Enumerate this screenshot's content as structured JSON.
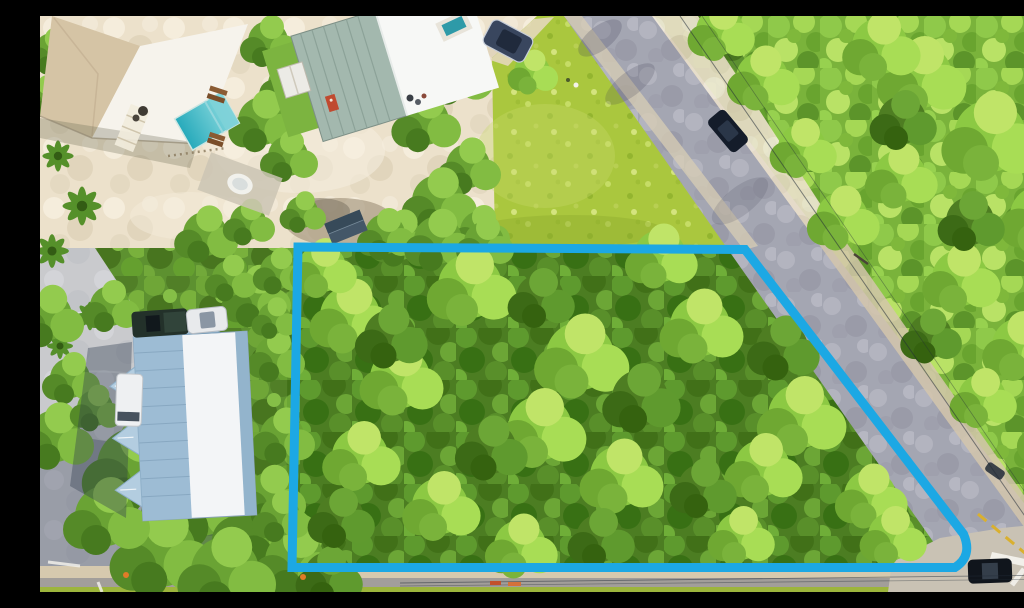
{
  "meta": {
    "kind": "aerial-drone-photograph",
    "subject": "vacant wooded corner lot outlined with a blue property boundary, neighboring homes with pool at top-left, diagonal access road on the right, street along the bottom",
    "canvas": {
      "width": 1024,
      "height": 576
    }
  },
  "annotation": {
    "boundary": {
      "label": "property-boundary-outline",
      "color": "#1CA8E4",
      "stroke_width": 9,
      "path": "M 258,231 L 705,233.5 L 923.5,518 Q 933,540 915,551.5 L 252,551.5 Z",
      "corners": [
        [
          258,
          231
        ],
        [
          705,
          233
        ],
        [
          924,
          518
        ],
        [
          915,
          552
        ],
        [
          252,
          552
        ]
      ]
    }
  },
  "palette": {
    "forest_base": "#5d9130",
    "forest_bright": "#7ab33b",
    "forest_dark": "#4c7d22",
    "field": "#aac73e",
    "sand": "#ece1cb",
    "road": "#a4a6b2",
    "road_shoulder": "#d3c6ab",
    "concrete": "#c9cacd",
    "intersection": "#c9c2b4",
    "sidewalk": "#d6c9ae",
    "bottom_road": "#a29e9a",
    "bottom_grass": "#9db53c",
    "pool_deep": "#27aabb",
    "pool_shallow": "#8fdce0",
    "roof_house_a_tan": "#d5c4a5",
    "roof_house_a_white": "#f6f3ec",
    "roof_house_b_metal": "#a3b8ae",
    "roof_house_b_white": "#f7f8f6",
    "roof_long_building": "#9dbcd4",
    "roof_long_building_white": "#f3f5f7",
    "shed_roof_dark": "#445768",
    "lawn": "#7cb440",
    "yellow_line": "#d9b02f",
    "marking_white": "#f2f0ea"
  },
  "features": [
    {
      "name": "property-boundary",
      "type": "annotation-overlay"
    },
    {
      "name": "wooded-lot",
      "type": "dense-tree-canopy"
    },
    {
      "name": "diagonal-access-road",
      "type": "road"
    },
    {
      "name": "grass-field",
      "type": "open-lot"
    },
    {
      "name": "house-with-pool",
      "type": "building"
    },
    {
      "name": "metal-roof-house",
      "type": "building"
    },
    {
      "name": "long-multiunit-building",
      "type": "building"
    },
    {
      "name": "swimming-pool",
      "type": "pool"
    },
    {
      "name": "street-intersection",
      "type": "road"
    },
    {
      "name": "crosswalk",
      "type": "road-marking"
    },
    {
      "name": "parked-vehicles",
      "type": "vehicles"
    },
    {
      "name": "power-lines",
      "type": "utility"
    }
  ]
}
